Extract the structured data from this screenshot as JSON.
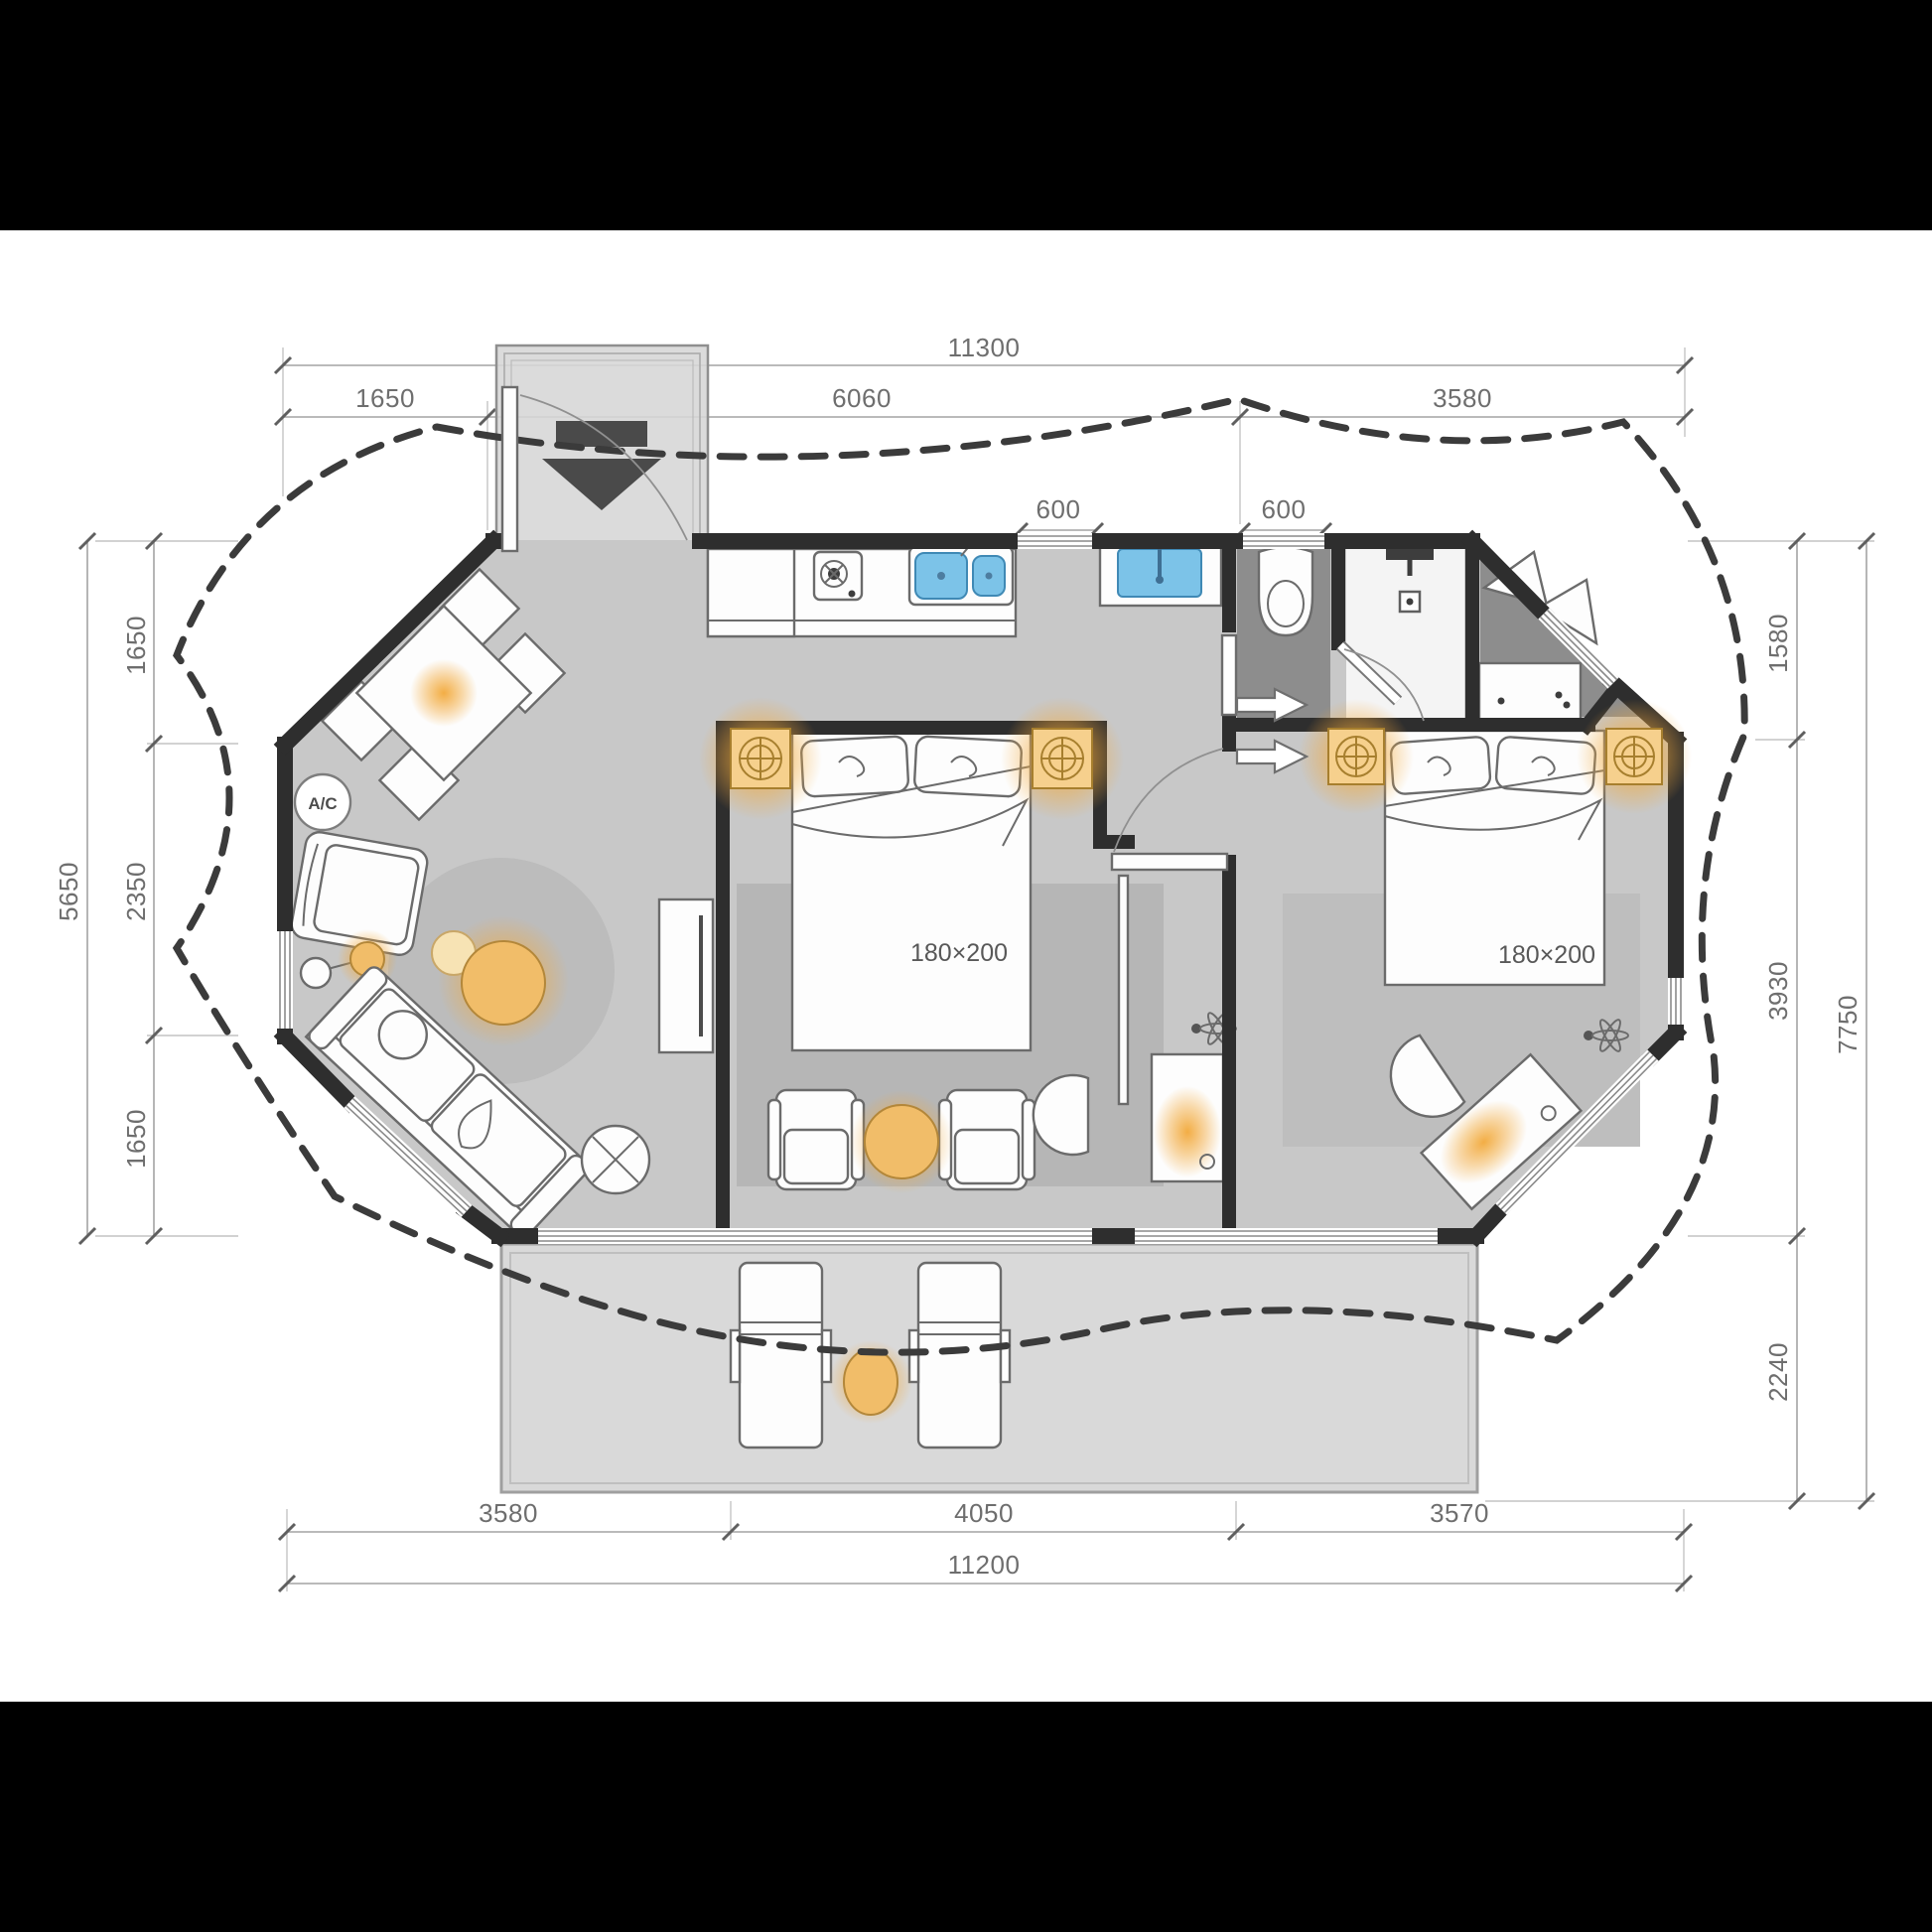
{
  "plan": {
    "type": "floor-plan",
    "style": "glamping-tent unit with octagonal platform, two bedrooms, bath zone, kitchen-living area and front deck"
  },
  "dimensions": {
    "top": {
      "overall": "11300",
      "segments": [
        "1650",
        "6060",
        "3580"
      ],
      "fixtures": [
        "600",
        "600"
      ]
    },
    "left": {
      "overall": "5650",
      "segments": [
        "1650",
        "2350",
        "1650"
      ]
    },
    "right": {
      "overall": "7750",
      "segments": [
        "1580",
        "3930",
        "2240"
      ]
    },
    "bottom": {
      "overall": "11200",
      "segments": [
        "3580",
        "4050",
        "3570"
      ]
    }
  },
  "labels": {
    "bed1_size": "180×200",
    "bed2_size": "180×200",
    "ac": "A/C"
  },
  "elements": [
    "entry-vestibule-arrow",
    "entry-door-swing",
    "dining-table",
    "dining-chairs",
    "ac-unit",
    "lounge-armchair",
    "floor-lamp",
    "round-rug",
    "coffee-table",
    "sofa",
    "side-table-x",
    "tv-console",
    "kitchen-counter",
    "stove",
    "double-sink",
    "washbasin",
    "toilet",
    "shower-head",
    "wardrobe-clothes",
    "dresser",
    "bed-1",
    "bed-2",
    "nightstands",
    "armchair-pair",
    "round-side-table",
    "desk-with-chair-1",
    "desk-with-chair-2",
    "ceiling-fan-1",
    "ceiling-fan-2",
    "deck-loungers",
    "deck-table",
    "tent-canopy-outline"
  ],
  "colors": {
    "letterbox": "#000000",
    "background": "#ffffff",
    "wall": "#2e2e2e",
    "floor": "#c8c8c8",
    "floor_dark": "#8d8d8d",
    "shower_floor": "#f4f4f4",
    "vestibule": "#d6d6d6",
    "deck": "#d9d9d9",
    "rug": "#b6b6b6",
    "glow_accent": "#f2a93b",
    "water_blue": "#7cc3e8",
    "canopy_dash": "#3b3b3b"
  }
}
